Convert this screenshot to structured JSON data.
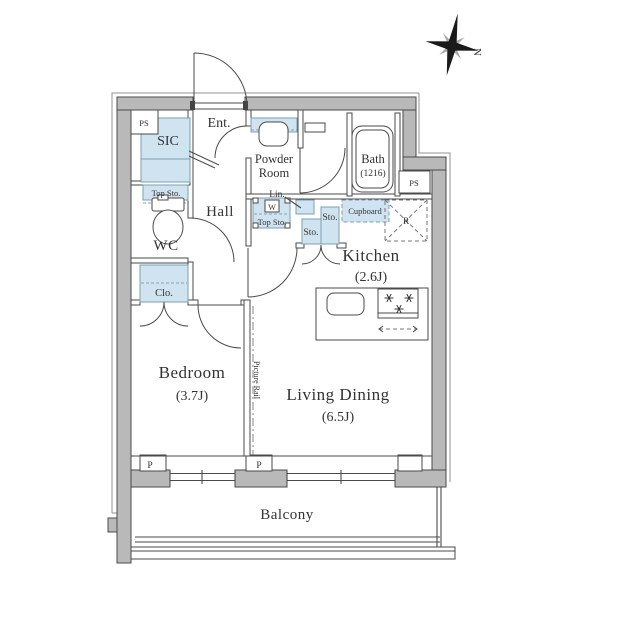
{
  "floor_plan": {
    "compass": {
      "north_label": "N"
    },
    "labels": {
      "entrance": "Ent.",
      "shoe_closet": "SIC",
      "wc_top_storage": "Top Sto.",
      "toilet_room": "WC",
      "hall": "Hall",
      "closet": "Clo.",
      "powder_room_line1": "Powder",
      "powder_room_line2": "Room",
      "bath_line1": "Bath",
      "bath_line2": "(1216)",
      "linen": "Lin.",
      "washer": "W",
      "washer_top_storage": "Top Sto.",
      "storage_a": "Sto.",
      "storage_b": "Sto.",
      "cupboard": "Cupboard",
      "refrigerator": "R",
      "kitchen_line1": "Kitchen",
      "kitchen_line2": "(2.6J)",
      "bedroom_line1": "Bedroom",
      "bedroom_line2": "(3.7J)",
      "living_dining_line1": "Living Dining",
      "living_dining_line2": "(6.5J)",
      "picture_rail": "Picture Rail",
      "balcony": "Balcony",
      "pipe_space_top_left": "PS",
      "pipe_space_right": "PS",
      "pillar_left": "P",
      "pillar_center": "P"
    },
    "colors": {
      "wall_fill": "#b9b9b9",
      "fixture_fill": "#cfe4f0",
      "line": "#4a4a4a"
    }
  }
}
